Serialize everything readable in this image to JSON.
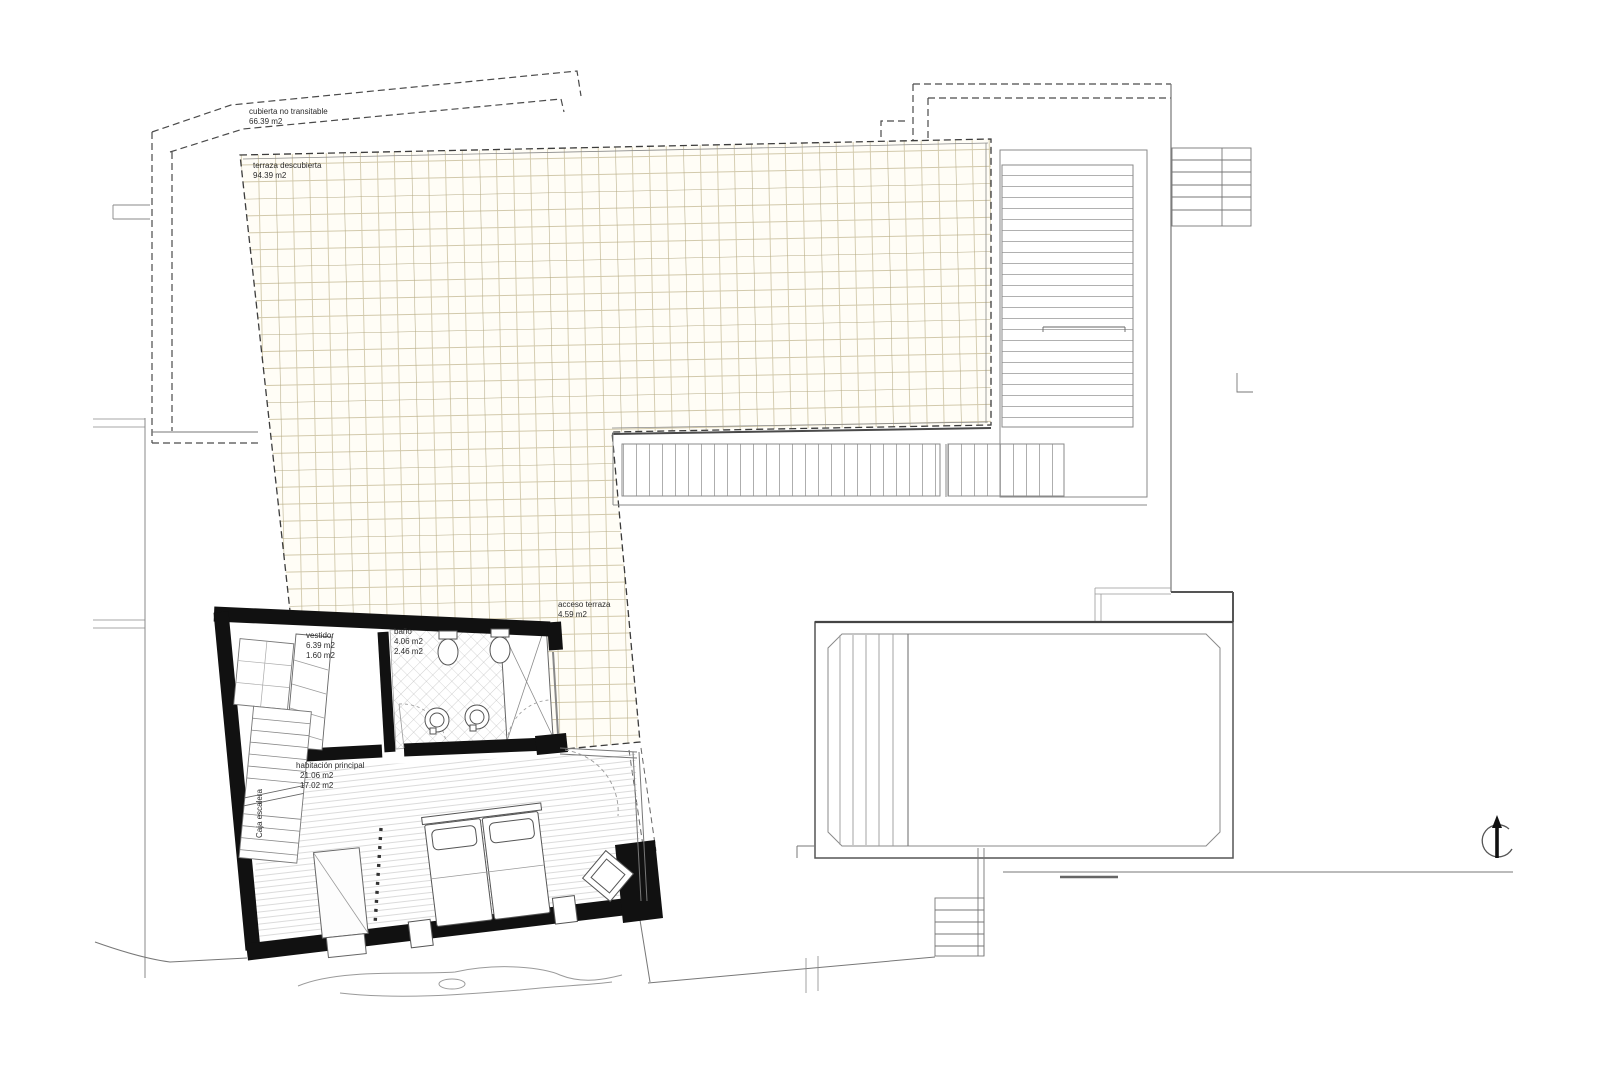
{
  "drawing": {
    "kind": "architectural floor plan - roof and bedroom level",
    "rooms": {
      "roof": {
        "label": "cubierta no transitable",
        "area": "66.39 m2"
      },
      "terrace": {
        "label": "terraza descubierta",
        "area": "94.39 m2"
      },
      "terrace_access": {
        "label": "acceso terraza",
        "area": "4.59 m2"
      },
      "dressing_room": {
        "label": "vestidor",
        "area": "6.39 m2",
        "area_alt": "1.60 m2"
      },
      "bathroom": {
        "label": "baño",
        "area": "4.06 m2",
        "area_alt": "2.46 m2"
      },
      "master_bedroom": {
        "label": "habitación principal",
        "area": "21.06 m2",
        "area_alt": "17.02 m2"
      },
      "stairwell": {
        "label": "Caja escalera"
      }
    },
    "symbols": {
      "north_arrow": "north-arrow"
    },
    "colors": {
      "paper": "#ffffff",
      "wall_fill": "#111111",
      "line": "#555555",
      "light_line": "#999999",
      "terrace_grid": "#d2c9ab",
      "terrace_grid_major": "#b4aa85",
      "tile_hatch": "#b0b0b0",
      "floorboard": "#cfcfcf"
    }
  }
}
